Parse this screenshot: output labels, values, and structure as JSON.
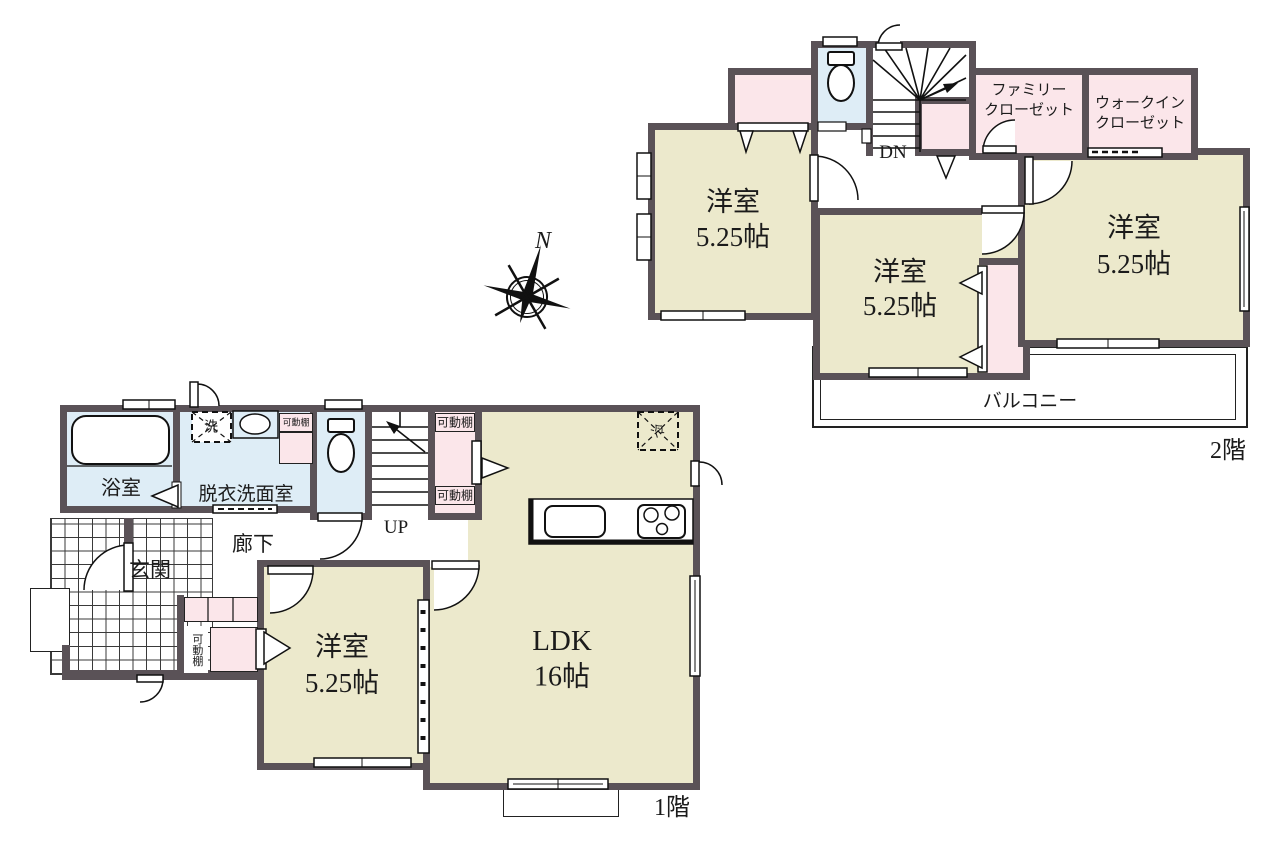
{
  "compass": {
    "north": "N"
  },
  "floor2": {
    "label": "2階",
    "stairs": "DN",
    "bedroom_west": {
      "name": "洋室",
      "size": "5.25帖"
    },
    "bedroom_middle": {
      "name": "洋室",
      "size": "5.25帖"
    },
    "bedroom_east": {
      "name": "洋室",
      "size": "5.25帖"
    },
    "family_closet": [
      "ファミリー",
      "クローゼット"
    ],
    "walkin_closet": [
      "ウォークイン",
      "クローゼット"
    ],
    "balcony": "バルコニー"
  },
  "floor1": {
    "label": "1階",
    "stairs": "UP",
    "bathroom": "浴室",
    "washroom": "脱衣洗面室",
    "hallway": "廊下",
    "entrance": "玄関",
    "bedroom": {
      "name": "洋室",
      "size": "5.25帖"
    },
    "ldk": {
      "name": "LDK",
      "size": "16帖"
    },
    "movable_shelf": "可動棚",
    "washer": "洗",
    "fridge": "冷"
  },
  "colors": {
    "wall": "#5a5257",
    "room": "#ece9cc",
    "closet": "#fbe6ea",
    "wet": "#deedf6"
  }
}
